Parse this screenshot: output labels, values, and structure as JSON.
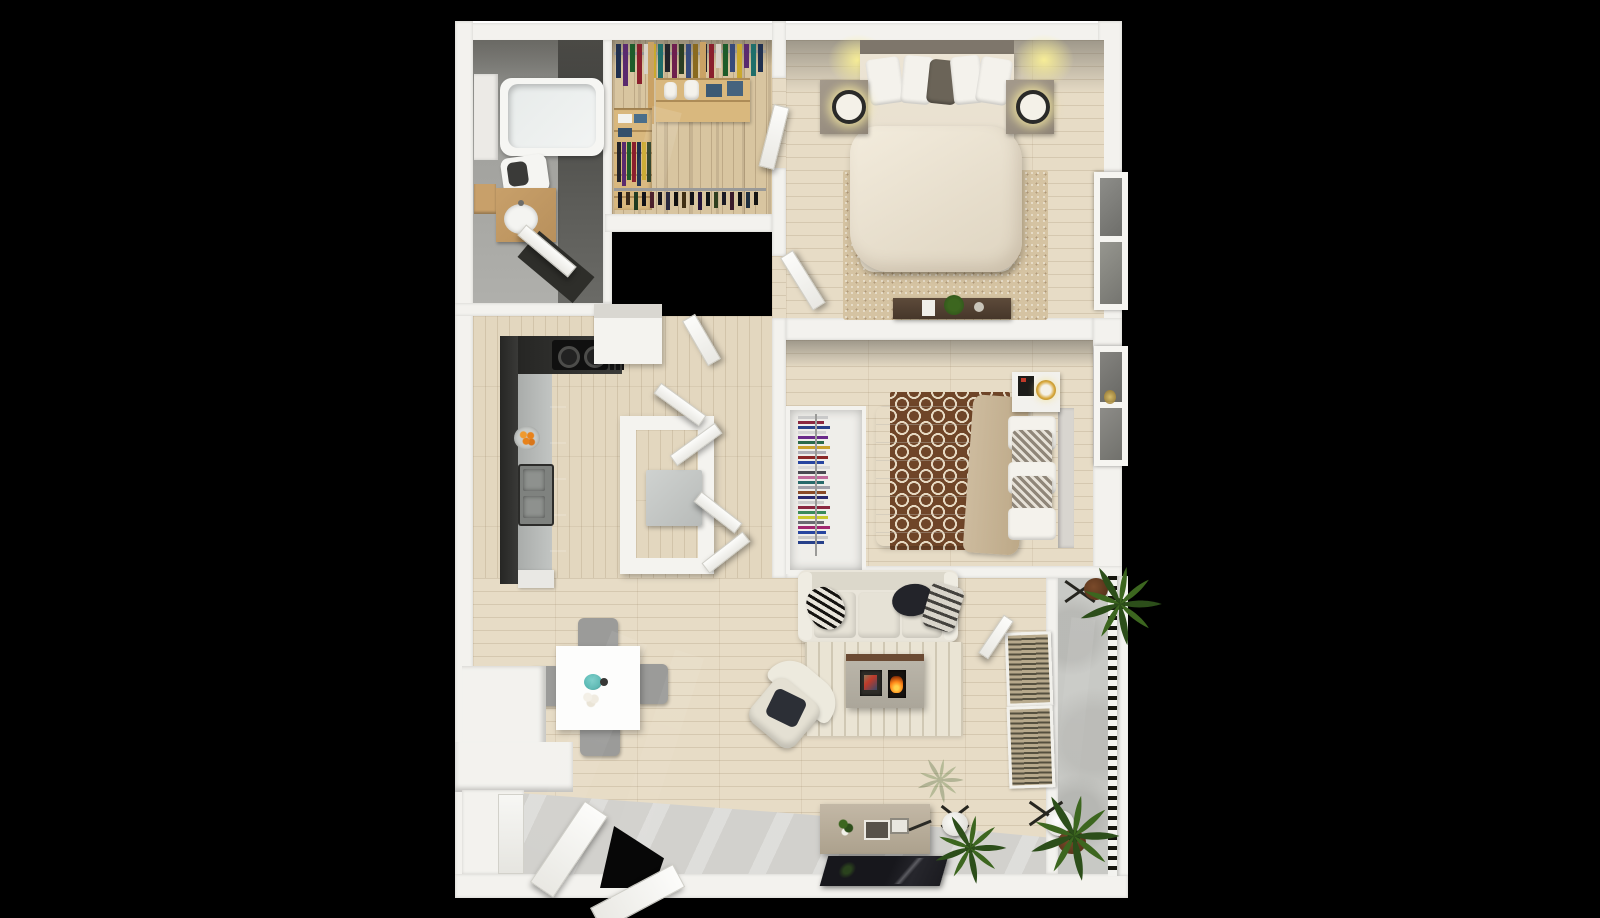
{
  "scene": {
    "title": "3D top-down floor plan of a two-bedroom apartment",
    "style": "dollhouse render on black background",
    "background": "#000000"
  },
  "palette": {
    "wall": "#f3f2ee",
    "wood_floor": "#e7dcc6",
    "closet_wood": "#d8c5a0",
    "bath_tile_light": "#9b9b97",
    "bath_tile_dark": "#4f4f4b",
    "entry_tile": "#d2d1cd",
    "balcony_concrete": "#c8c9c5",
    "rug_bedroom1": "#d5c3a2",
    "rug_bedroom2_brown": "#6f4528",
    "rug_bedroom2_cream": "#e6d9c2",
    "rug_living": "#eae4d4",
    "sofa": "#e9e5da",
    "kitchen_cabinet": "#2e2e2c",
    "kitchen_counter": "#b9bcba",
    "bench_wood": "#564434",
    "fire_glow": "#ff8718",
    "vase_teal": "#58b7b2",
    "lamp_glow": "#f5e9a0",
    "lamp_gold": "#d8a83c",
    "palm_green": "#335a1e",
    "oranges": "#e8821a"
  },
  "rooms": [
    {
      "id": "bathroom",
      "label": "Bathroom",
      "furniture": [
        "bathtub",
        "toilet",
        "wood-vanity-with-round-sink",
        "side-shelf",
        "open-door"
      ]
    },
    {
      "id": "walk-in-closet",
      "label": "Walk-in Closet",
      "furniture": [
        "hanging-clothes-rod-left",
        "hanging-clothes-rod-right",
        "wood-shelving",
        "folded-towels",
        "shoe-and-bottle-rack"
      ]
    },
    {
      "id": "bedroom-1",
      "label": "Bedroom 1",
      "furniture": [
        "double-bed-cream-duvet",
        "nightstand-left-with-lamp",
        "nightstand-right-with-lamp",
        "ceiling-light-glows",
        "beige-area-rug",
        "dark-storage-bench-with-plant",
        "right-wall-window",
        "open-door"
      ]
    },
    {
      "id": "bedroom-2",
      "label": "Bedroom 2",
      "furniture": [
        "double-bed-white-duvet-tan-throw",
        "chevron-pillows",
        "brown-trellis-rug",
        "reach-in-closet-stacked-clothes",
        "white-nightstand-art-frames-gold-lamp",
        "right-wall-window",
        "open-door"
      ]
    },
    {
      "id": "kitchen-hall",
      "label": "Kitchen / Hall",
      "furniture": [
        "l-shaped-dark-counter",
        "black-cooktop",
        "double-sink",
        "fruit-bowl-oranges",
        "hall-closet-open-door",
        "laundry-nook-bifold-doors",
        "washer"
      ]
    },
    {
      "id": "living-dining",
      "label": "Living / Dining",
      "furniture": [
        "white-dining-table",
        "four-gray-chairs",
        "teal-vase-flowers",
        "cream-sofa-three-pillows",
        "striped-living-rug",
        "fireplace-media-console",
        "swivel-armchair-dark-pillow",
        "media-sideboard",
        "flat-tv-panel",
        "potted-plant-white-stand",
        "half-wall-ledge",
        "entry-closet",
        "two-open-entry-doors"
      ]
    },
    {
      "id": "balcony",
      "label": "Balcony",
      "furniture": [
        "baluster-railing",
        "palm-plant-north",
        "palm-plant-south",
        "bistro-chairs",
        "louvered-shutters"
      ]
    }
  ],
  "closet": {
    "rod1_colors": [
      "#20304f",
      "#5a2a6e",
      "#1d5c2a",
      "#8a1f2d",
      "#d8d2c8",
      "#caa92e",
      "#1f6e6a",
      "#23242a",
      "#6e1f4e",
      "#2a3d23",
      "#374a7a",
      "#8a6a1f"
    ],
    "rod2_colors": [
      "#23242a",
      "#8a1f2d",
      "#d8d2c8",
      "#1d5c2a",
      "#374a7a",
      "#caa92e",
      "#5a2a6e",
      "#1f6e6a",
      "#20304f"
    ],
    "rod3_colors": [
      "#23242a",
      "#5a2a6e",
      "#1d5c2a",
      "#8a1f2d",
      "#20304f",
      "#caa92e",
      "#2a3d23"
    ],
    "rack_colors": [
      "#14141a",
      "#3a2a1a",
      "#1f3a1f",
      "#101014",
      "#4a1f2a",
      "#14141a",
      "#2a2a3f",
      "#101010",
      "#3f2f14",
      "#14141a",
      "#24143a",
      "#101418",
      "#2f3f1f",
      "#1a1a24",
      "#3a1a2a",
      "#101014",
      "#1f2f3f",
      "#141414"
    ],
    "towel_colors": [
      "#f2f2ee",
      "#4a6e8a",
      "#f2f2ee",
      "#35506b"
    ]
  },
  "bedroom2_closet": {
    "stack_colors": [
      "#c9c9c9",
      "#8a2740",
      "#27408a",
      "#d4d4d4",
      "#6a2a8a",
      "#2a6a4a",
      "#c9a22e",
      "#b0b0b8",
      "#8a2727",
      "#2745a0",
      "#d8d8d8",
      "#4a4a52",
      "#c06a9a",
      "#276a6a",
      "#a0a0a8",
      "#8a4a27",
      "#2a2a70",
      "#cccccc",
      "#8a2740",
      "#3a8a5a",
      "#c9c92e",
      "#6a6a72",
      "#a02770",
      "#2745a0",
      "#c9c9c9",
      "#27408a"
    ]
  }
}
